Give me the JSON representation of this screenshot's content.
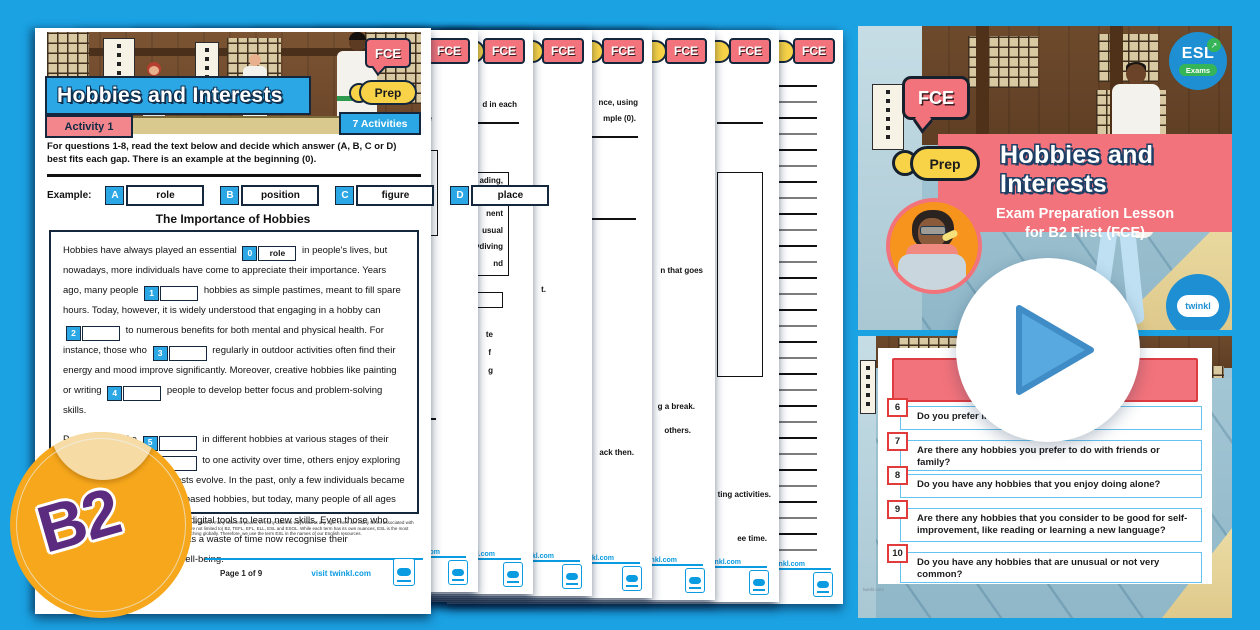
{
  "worksheet": {
    "exam_badge": "FCE",
    "prep_badge": "Prep",
    "title": "Hobbies and Interests",
    "activity_badge": "Activity 1",
    "activities_badge": "7 Activities",
    "instructions": "For questions 1-8, read the text below and decide which answer (A, B, C or D) best fits each gap. There is an example at the beginning (0).",
    "example_label": "Example:",
    "example_options": [
      {
        "letter": "A",
        "word": "role"
      },
      {
        "letter": "B",
        "word": "position"
      },
      {
        "letter": "C",
        "word": "figure"
      },
      {
        "letter": "D",
        "word": "place"
      }
    ],
    "passage_title": "The Importance of Hobbies",
    "paragraph1": [
      {
        "text": "Hobbies have always played an essential"
      },
      {
        "gap": "0",
        "answer": "role"
      },
      {
        "text": "in people's lives, but nowadays, more individuals have come to appreciate their importance. Years ago, many people"
      },
      {
        "gap": "1"
      },
      {
        "text": "hobbies as simple pastimes, meant to fill spare hours. Today, however, it is widely understood that engaging in a hobby can"
      },
      {
        "gap": "2"
      },
      {
        "text": "to numerous benefits for both mental and physical health. For instance, those who"
      },
      {
        "gap": "3"
      },
      {
        "text": "regularly in outdoor activities often find their energy and mood improve significantly. Moreover, creative hobbies like painting or writing"
      },
      {
        "gap": "4"
      },
      {
        "text": "people to develop better focus and problem-solving skills."
      }
    ],
    "paragraph2": [
      {
        "text": "People often take"
      },
      {
        "gap": "5"
      },
      {
        "text": "in different hobbies at various stages of their lives. While some"
      },
      {
        "gap": "6"
      },
      {
        "text": "to one activity over time, others enjoy exploring new pastimes as their interests evolve. In the past, only a few individuals became"
      },
      {
        "gap": "7"
      },
      {
        "text": "in technology-based hobbies, but today, many people of all ages take up online courses or use digital tools to learn new skills. Even those who had previously seen hobbies as a waste of time now recognise their"
      },
      {
        "gap": "8"
      },
      {
        "text": "for personal well-being."
      }
    ],
    "footer": {
      "fine_print": "At Twinkl, we know that students can be learning English in many different places, in many different ways and at any age. There are many terms associated with English language teaching. These include (but are not limited to) B2, TEFL, EFL, ELL, ESL and ESOL. While each term has its own nuances, ESL is the most widely recognised term for English language teaching globally. Therefore, we use the term ESL in the names of our English resources.",
      "page_label": "Page 1 of 9",
      "visit_label": "visit twinkl.com"
    }
  },
  "stack_pages": [
    {
      "fce": "FCE",
      "prep": "Prep",
      "visit": "visit twinkl.com",
      "fragments": [
        {
          "type": "text",
          "label": "e",
          "top": 84,
          "right": 46
        },
        {
          "type": "box",
          "top": 120,
          "right": 40,
          "w": 120,
          "h": 86
        },
        {
          "type": "line",
          "top": 388,
          "right": 42,
          "w": 110
        }
      ]
    },
    {
      "fce": "FCE",
      "prep": "Prep",
      "visit": "visit twinkl.com",
      "fragments": [
        {
          "type": "text",
          "label": "d in each",
          "top": 70,
          "right": 16
        },
        {
          "type": "line",
          "top": 92,
          "right": 14,
          "w": 120
        },
        {
          "type": "box",
          "top": 142,
          "right": 24,
          "w": 110,
          "h": 104,
          "lines": [
            "ading,",
            "e",
            "nent",
            "usual",
            "ydiving",
            "nd"
          ]
        },
        {
          "type": "box",
          "top": 262,
          "right": 30,
          "w": 78,
          "h": 16
        },
        {
          "type": "text",
          "label": "te",
          "top": 300,
          "right": 40
        },
        {
          "type": "text",
          "label": "f",
          "top": 318,
          "right": 42
        },
        {
          "type": "text",
          "label": "g",
          "top": 336,
          "right": 40
        }
      ]
    },
    {
      "fce": "FCE",
      "prep": "Prep",
      "visit": "visit twinkl.com",
      "fragments": [
        {
          "type": "text",
          "label": "t.",
          "top": 255,
          "right": 46
        }
      ]
    },
    {
      "fce": "FCE",
      "prep": "Prep",
      "visit": "visit twinkl.com",
      "fragments": [
        {
          "type": "text",
          "label": "nce, using",
          "top": 68,
          "right": 14
        },
        {
          "type": "text",
          "label": "mple (0).",
          "top": 84,
          "right": 16
        },
        {
          "type": "line",
          "top": 106,
          "right": 14,
          "w": 130
        },
        {
          "type": "line",
          "top": 188,
          "right": 16,
          "w": 130
        },
        {
          "type": "text",
          "label": "ack then.",
          "top": 418,
          "right": 18
        }
      ]
    },
    {
      "fce": "FCE",
      "prep": "Prep",
      "visit": "visit twinkl.com",
      "fragments": [
        {
          "type": "text",
          "label": "n that goes",
          "top": 236,
          "right": 12
        },
        {
          "type": "text",
          "label": "g a break.",
          "top": 372,
          "right": 20
        },
        {
          "type": "text",
          "label": "others.",
          "top": 396,
          "right": 24
        }
      ]
    },
    {
      "fce": "FCE",
      "prep": "Prep",
      "visit": "visit twinkl.com",
      "fragments": [
        {
          "type": "line",
          "top": 92,
          "right": 16,
          "w": 46
        },
        {
          "type": "box",
          "top": 142,
          "right": 16,
          "w": 46,
          "h": 205
        },
        {
          "type": "text",
          "label": "ting activities.",
          "top": 460,
          "right": 8
        },
        {
          "type": "text",
          "label": "ee time.",
          "top": 504,
          "right": 12
        }
      ]
    },
    {
      "fce": "FCE",
      "prep": "Prep",
      "visit": "visit twinkl.com",
      "fragments": [
        {
          "type": "rules",
          "top": 55,
          "right": 26,
          "w": 38,
          "count": 30,
          "step": 16
        }
      ]
    }
  ],
  "slides": {
    "slide1": {
      "esl_logo": {
        "line1": "ESL",
        "line2": "Exams"
      },
      "fce_bubble": "FCE",
      "prep_pill": "Prep",
      "title": "Hobbies and Interests",
      "subtitle_line1": "Exam Preparation Lesson",
      "subtitle_line2": "for B2 First (FCE)",
      "twinkl_logo": "twinkl"
    },
    "slide2": {
      "watermark": "twinkl.com",
      "questions": [
        {
          "num": "6",
          "text": "Do you prefer indoor or outdoor hobbies?"
        },
        {
          "num": "7",
          "text": "Are there any hobbies you prefer to do with friends or family?"
        },
        {
          "num": "8",
          "text": "Do you have any hobbies that you enjoy doing alone?"
        },
        {
          "num": "9",
          "text": "Are there any hobbies that you consider to be good for self-improvement, like reading or learning a new language?"
        },
        {
          "num": "10",
          "text": "Do you have any hobbies that are unusual or not very common?"
        }
      ]
    }
  },
  "level_badge": "B2",
  "colors": {
    "background": "#1BA2E3",
    "twinkl_blue": "#2AA7E4",
    "pink": "#F2737B",
    "yellow": "#F9D347",
    "red_border": "#E23B3B",
    "row_border": "#66C2EE",
    "orange_badge": "#F6A71B",
    "purple": "#5B2B80",
    "green": "#35B558",
    "play_blue": "#58A9DF"
  }
}
